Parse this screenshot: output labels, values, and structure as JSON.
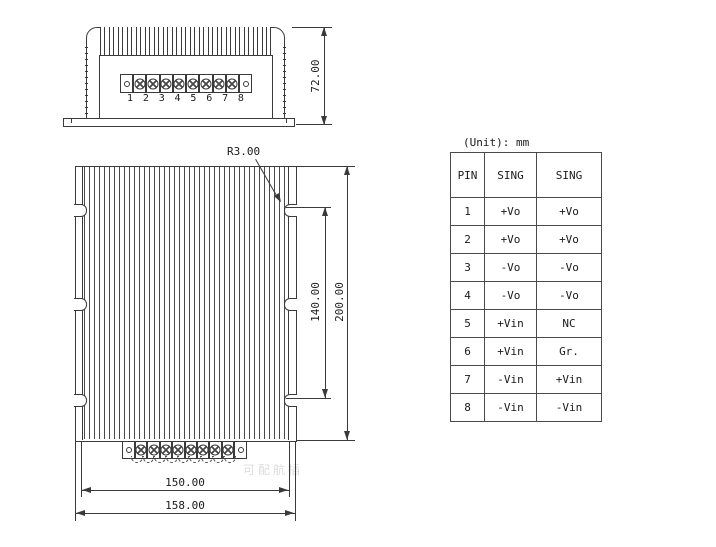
{
  "unit_label": "(Unit): mm",
  "watermark_text": "可配航插",
  "dimensions": {
    "front_height": "72.00",
    "corner_radius": "R3.00",
    "slot_spacing": "140.00",
    "body_length": "200.00",
    "fin_width": "150.00",
    "base_width": "158.00"
  },
  "front_view": {
    "pin_numbers": [
      "1",
      "2",
      "3",
      "4",
      "5",
      "6",
      "7",
      "8"
    ]
  },
  "pin_table": {
    "headers": [
      "PIN",
      "SING",
      "SING"
    ],
    "rows": [
      [
        "1",
        "+Vo",
        "+Vo"
      ],
      [
        "2",
        "+Vo",
        "+Vo"
      ],
      [
        "3",
        "-Vo",
        "-Vo"
      ],
      [
        "4",
        "-Vo",
        "-Vo"
      ],
      [
        "5",
        "+Vin",
        "NC"
      ],
      [
        "6",
        "+Vin",
        "Gr."
      ],
      [
        "7",
        "-Vin",
        "+Vin"
      ],
      [
        "8",
        "-Vin",
        "-Vin"
      ]
    ]
  }
}
